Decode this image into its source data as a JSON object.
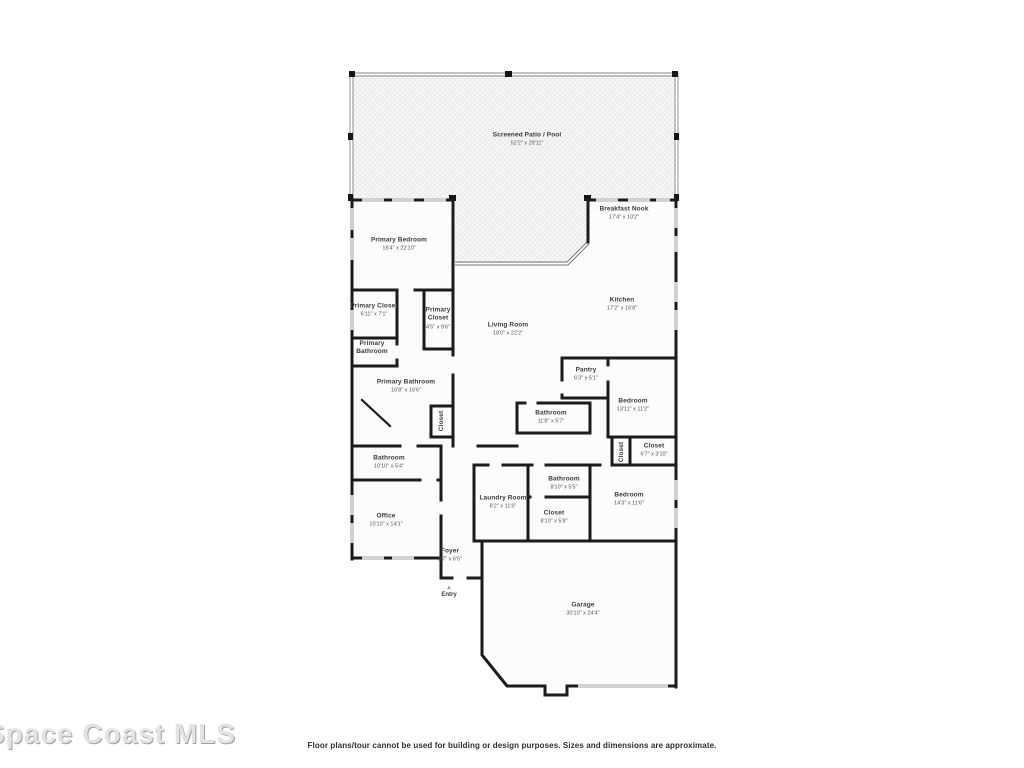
{
  "page": {
    "watermark": "Space Coast MLS",
    "disclaimer": "Floor plans/tour cannot be used for building or design purposes. Sizes and dimensions are approximate."
  },
  "plan": {
    "entry_label": "Entry",
    "colors": {
      "wall": "#1b1b1b",
      "room_fill": "#fcfcfc",
      "patio_hatch": "#e6e6e6",
      "screen_line": "#8a8a8a"
    },
    "rooms": [
      {
        "id": "screened-patio-pool",
        "name": "Screened Patio / Pool",
        "dims": "52'2\" x 29'11\""
      },
      {
        "id": "primary-bedroom",
        "name": "Primary Bedroom",
        "dims": "16'4\" x 22'10\""
      },
      {
        "id": "breakfast-nook",
        "name": "Breakfast Nook",
        "dims": "17'4\" x 10'2\""
      },
      {
        "id": "kitchen",
        "name": "Kitchen",
        "dims": "17'2\" x 16'8\""
      },
      {
        "id": "living-room",
        "name": "Living Room",
        "dims": "18'0\" x 22'2\""
      },
      {
        "id": "primary-closet-1",
        "name": "Primary Closet",
        "dims": "6'11\" x 7'1\""
      },
      {
        "id": "primary-closet-2",
        "name": "Primary Closet",
        "dims": "4'5\" x 9'6\""
      },
      {
        "id": "primary-bathroom-wc",
        "name": "Primary Bathroom",
        "dims": ""
      },
      {
        "id": "primary-bathroom",
        "name": "Primary Bathroom",
        "dims": "16'8\" x 16'6\""
      },
      {
        "id": "closet-vertical-1",
        "name": "Closet",
        "dims": ""
      },
      {
        "id": "pantry",
        "name": "Pantry",
        "dims": "6'3\" x 5'1\""
      },
      {
        "id": "bedroom-middle",
        "name": "Bedroom",
        "dims": "13'11\" x 11'2\""
      },
      {
        "id": "bathroom-center",
        "name": "Bathroom",
        "dims": "11'8\" x 5'7\""
      },
      {
        "id": "closet-vertical-2",
        "name": "Closet",
        "dims": ""
      },
      {
        "id": "closet-right",
        "name": "Closet",
        "dims": "6'7\" x 3'10\""
      },
      {
        "id": "bathroom-left",
        "name": "Bathroom",
        "dims": "10'10\" x 5'4\""
      },
      {
        "id": "office",
        "name": "Office",
        "dims": "10'10\" x 14'1\""
      },
      {
        "id": "laundry-room",
        "name": "Laundry Room",
        "dims": "8'2\" x 11'6\""
      },
      {
        "id": "bathroom-2",
        "name": "Bathroom",
        "dims": "8'10\" x 5'5\""
      },
      {
        "id": "closet-2",
        "name": "Closet",
        "dims": "8'10\" x 5'8\""
      },
      {
        "id": "bedroom-lower",
        "name": "Bedroom",
        "dims": "14'3\" x 11'6\""
      },
      {
        "id": "foyer",
        "name": "Foyer",
        "dims": "8'7\" x 6'5\""
      },
      {
        "id": "garage",
        "name": "Garage",
        "dims": "30'10\" x 24'4\""
      }
    ]
  }
}
